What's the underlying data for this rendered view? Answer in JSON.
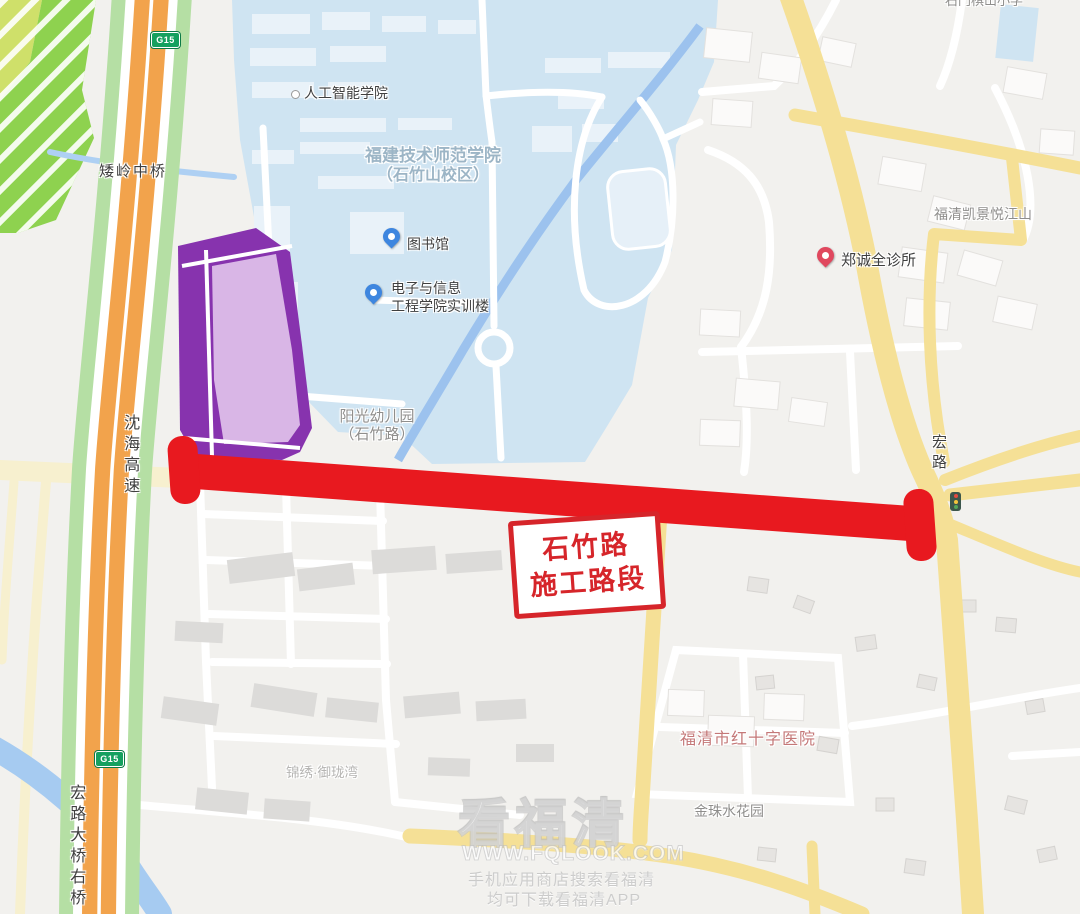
{
  "map": {
    "badge_g15": "G15",
    "labels": {
      "bridge_top": "矮岭中桥",
      "expressway": "沈海高速",
      "ai_college": "人工智能学院",
      "university_line1": "福建技术师范学院",
      "university_line2": "（石竹山校区）",
      "library": "图书馆",
      "training_line1": "电子与信息",
      "training_line2": "工程学院实训楼",
      "kindergarten_line1": "阳光幼儿园",
      "kindergarten_line2": "（石竹路）",
      "clinic": "郑诚全诊所",
      "kaijing_estate": "福清凯景悦江山",
      "school_top_right": "石门棋山小学",
      "honglu_road": "宏路",
      "hospital": "福清市红十字医院",
      "jinzhu_estate": "金珠水花园",
      "jinxiu_estate": "锦绣·御珑湾",
      "bridge_bottom": "宏路大桥右桥"
    },
    "construction_label": {
      "line1": "石竹路",
      "line2": "施工路段"
    },
    "watermark": {
      "title": "看福清",
      "url": "WWW.FQLOOK.COM",
      "line1": "手机应用商店搜索看福清",
      "line2": "均可下载看福清APP"
    },
    "colors": {
      "construction_red": "#e8191f",
      "label_box_red": "#d6252a",
      "campus_blue": "#cfe4f2",
      "water_blue": "#a6cbf1",
      "road_yellow": "#f5e096",
      "road_cream": "#f7f0cf",
      "expressway_orange": "#f2a34c",
      "verge_green": "#b5dfa4",
      "park_green": "#8ed24f",
      "poi_purple_dark": "#8733ae",
      "poi_purple_light": "#d9b6e6",
      "badge_green": "#15a05f"
    }
  }
}
